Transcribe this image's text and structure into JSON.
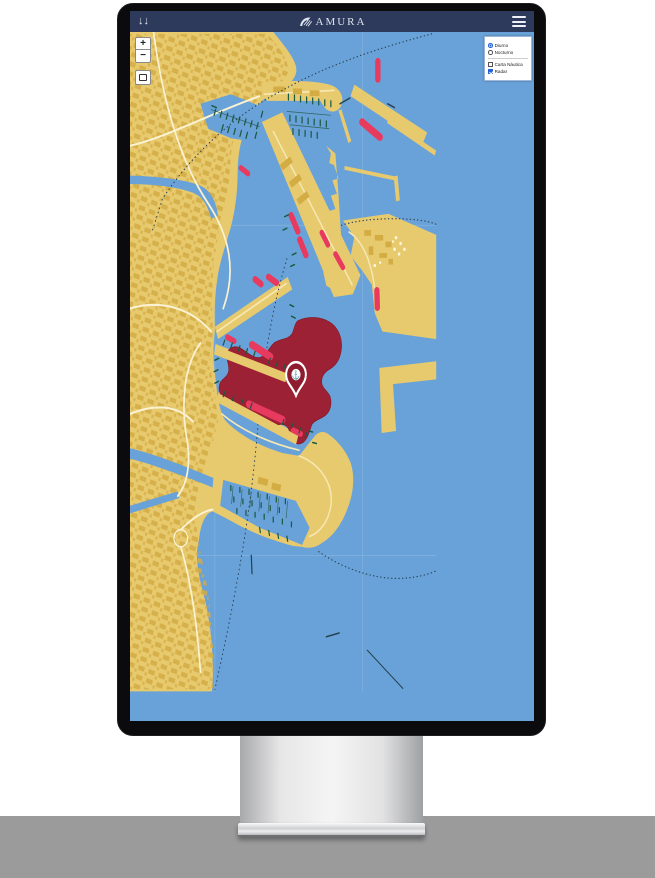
{
  "window": {
    "name": "monitor-with-map-app"
  },
  "navbar": {
    "logo_text": "AMURA",
    "left_icon_glyph": "↓↓",
    "menu_icon": "hamburger"
  },
  "map_controls": {
    "zoom_in_label": "+",
    "zoom_out_label": "−",
    "extent_icon": "square-outline"
  },
  "layer_panel": {
    "options": [
      {
        "label": "Diurno",
        "type": "radio",
        "checked": true
      },
      {
        "label": "Nocturno",
        "type": "radio",
        "checked": false
      },
      {
        "label": "Carta Náutica",
        "type": "checkbox",
        "checked": false
      },
      {
        "label": "Radar",
        "type": "checkbox",
        "checked": true
      }
    ]
  },
  "marker": {
    "glyph": "⚓",
    "meaning": "vessel-location-pin"
  },
  "colors": {
    "navbar": "#2e3a5c",
    "water": "#69a2d8",
    "land": "#e8ca6e",
    "buildings": "#d3ac44",
    "radar_overlay": "#9d2134",
    "ship": "#e8395f",
    "boat_marks": "#1b5840",
    "route_dots": "#2c4356",
    "pin": "#8e1c2e",
    "panel_accent": "#2563d4",
    "floor": "#9b9b9b"
  }
}
